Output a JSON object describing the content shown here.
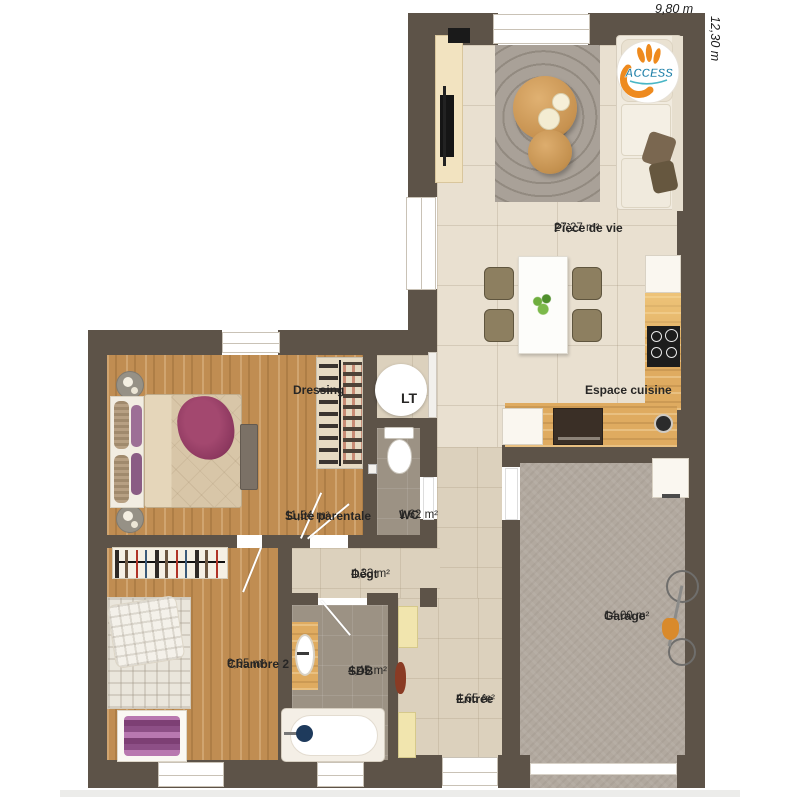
{
  "plan": {
    "logo": {
      "text": "ACCESS"
    },
    "dimensions": {
      "top": "9,80 m",
      "right": "12,30 m"
    },
    "rooms": {
      "piece_de_vie": {
        "name": "Pièce de vie",
        "area": "27,27 m²"
      },
      "espace_cuisine": {
        "name": "Espace cuisine",
        "area": ""
      },
      "dressing": {
        "name": "Dressing",
        "area": ""
      },
      "lt": {
        "name": "LT",
        "area": ""
      },
      "wc": {
        "name": "WC",
        "area": "1,62 m²"
      },
      "suite_parentale": {
        "name": "Suite parentale",
        "area": "11,54 m²"
      },
      "degt": {
        "name": "Dégt",
        "area": "4,33 m²"
      },
      "chambre2": {
        "name": "Chambre 2",
        "area": "9,05 m²"
      },
      "sdb": {
        "name": "SDB",
        "area": "4,45 m²"
      },
      "entree": {
        "name": "Entrée",
        "area": "4,65 m²"
      },
      "garage": {
        "name": "Garage",
        "area": "14,00 m²"
      }
    },
    "colors": {
      "wall": "#5d5348",
      "wood_floor": "#c08d52",
      "living_tile": "#e9e0d0",
      "hall_tile": "#dcd1bd",
      "bath_tile": "#9c9284",
      "garage_floor": "#b2a99f",
      "logo_orange": "#ee8a1e",
      "logo_blue": "#1d7fa8"
    }
  }
}
